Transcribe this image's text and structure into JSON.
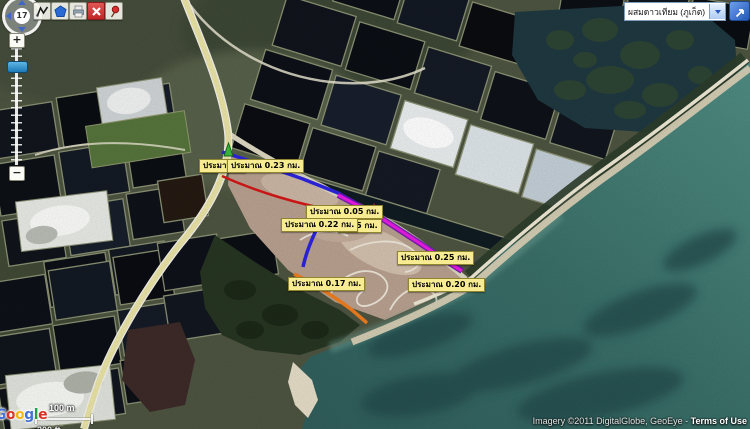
{
  "map_controls": {
    "zoom_level": "17",
    "zoom_in_label": "+",
    "zoom_out_label": "−"
  },
  "toolbar": {
    "buttons": [
      {
        "icon": "measure-polyline-icon"
      },
      {
        "icon": "measure-polygon-icon"
      },
      {
        "icon": "print-icon"
      },
      {
        "icon": "clear-x-icon"
      },
      {
        "icon": "pushpin-icon"
      }
    ]
  },
  "layer_select": {
    "value": "ผสมดาวเทียม (ภูเก็ต)"
  },
  "measurements": {
    "colors": {
      "blue": "#2a22d2",
      "red": "#c81616",
      "magenta": "#e018d8",
      "magenta_casing": "#6a0fa8",
      "orange": "#e2761c",
      "start_marker": "#38b23c",
      "point_marker": "#d42020",
      "label_background": "#f7ec92"
    },
    "labels": [
      {
        "text": "ประมาณ 0"
      },
      {
        "text": "ประมาณ 0.23 กม."
      },
      {
        "text": "ประมาณ 0.05 กม."
      },
      {
        "text": "ประมาณ 0.22 กม."
      },
      {
        "text": "0.15 กม."
      },
      {
        "text": "ประมาณ 0.25 กม."
      },
      {
        "text": "ประมาณ 0.17 กม."
      },
      {
        "text": "ประมาณ 0.20 กม."
      }
    ]
  },
  "scale_bar": {
    "metric": "100 m",
    "imperial": "200 ft"
  },
  "attribution": {
    "logo": "Google",
    "logo_colors": [
      "#4270d8",
      "#d93025",
      "#f2b50f",
      "#4270d8",
      "#1e9e3e",
      "#d93025"
    ],
    "imagery_text": "Imagery ©2011 DigitalGlobe, GeoEye - ",
    "terms": "Terms of Use"
  }
}
